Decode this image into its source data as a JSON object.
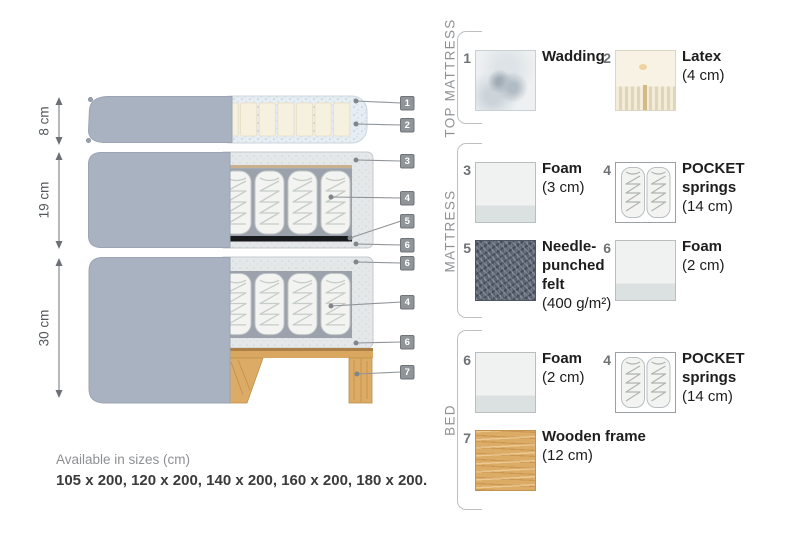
{
  "diagram": {
    "dimensions": [
      {
        "label": "8 cm"
      },
      {
        "label": "19 cm"
      },
      {
        "label": "30 cm"
      }
    ],
    "callouts": [
      {
        "n": "1"
      },
      {
        "n": "2"
      },
      {
        "n": "3"
      },
      {
        "n": "4"
      },
      {
        "n": "5"
      },
      {
        "n": "6"
      },
      {
        "n": "6"
      },
      {
        "n": "4"
      },
      {
        "n": "6"
      },
      {
        "n": "7"
      }
    ],
    "availability": {
      "title": "Available in sizes (cm)",
      "sizes": "105 x 200, 120 x 200, 140 x 200, 160 x 200, 180 x 200."
    }
  },
  "legend": {
    "sections": [
      {
        "title": "TOP MATTRESS",
        "items": [
          {
            "num": "1",
            "name": "Wadding",
            "detail": "",
            "swatch": "wadding"
          },
          {
            "num": "2",
            "name": "Latex",
            "detail": "(4 cm)",
            "swatch": "latex"
          }
        ]
      },
      {
        "title": "MATTRESS",
        "items": [
          {
            "num": "3",
            "name": "Foam",
            "detail": "(3 cm)",
            "swatch": "foam"
          },
          {
            "num": "4",
            "name": "POCKET\nsprings",
            "detail": "(14 cm)",
            "swatch": "pocket-springs"
          },
          {
            "num": "5",
            "name": "Needle-\npunched\nfelt",
            "detail": "(400 g/m²)",
            "swatch": "felt"
          },
          {
            "num": "6",
            "name": "Foam",
            "detail": "(2 cm)",
            "swatch": "foam"
          }
        ]
      },
      {
        "title": "BED",
        "items": [
          {
            "num": "6",
            "name": "Foam",
            "detail": "(2 cm)",
            "swatch": "foam"
          },
          {
            "num": "4",
            "name": "POCKET\nsprings",
            "detail": "(14 cm)",
            "swatch": "pocket-springs"
          },
          {
            "num": "7",
            "name": "Wooden frame",
            "detail": "(12 cm)",
            "swatch": "wood"
          }
        ]
      }
    ]
  },
  "colors": {
    "fabric_grey": "#a9b2c0",
    "wadding_blue": "#e7eef3",
    "latex_cream": "#f6f0df",
    "foam_light": "#f0f2f2",
    "felt_dark": "#5a6370",
    "wood_tan": "#dcab66",
    "callout_chip": "#90959a",
    "felt_strip_black": "#17191b"
  }
}
